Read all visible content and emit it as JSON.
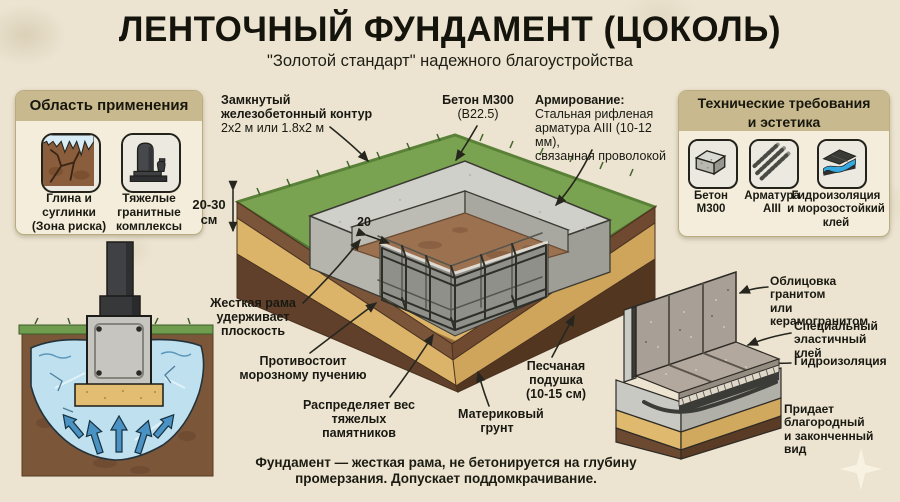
{
  "header": {
    "title": "ЛЕНТОЧНЫЙ ФУНДАМЕНТ (ЦОКОЛЬ)",
    "subtitle": "\"Золотой стандарт\" надежного благоустройства"
  },
  "left_panel": {
    "title": "Область применения",
    "items": [
      {
        "icon": "cracked-clay-icon",
        "label": "Глина и\nсуглинки\n(Зона риска)"
      },
      {
        "icon": "gravestone-icon",
        "label": "Тяжелые\nгранитные\nкомплексы"
      }
    ]
  },
  "right_panel": {
    "title": "Технические требования\nи эстетика",
    "items": [
      {
        "icon": "concrete-block-icon",
        "label": "Бетон\nМ300"
      },
      {
        "icon": "rebar-icon",
        "label": "Арматура\nAIII"
      },
      {
        "icon": "waterproofing-icon",
        "label": "Гидроизоляция\nи морозостойкий\nклей"
      }
    ]
  },
  "diagram": {
    "callouts": {
      "contour_title": "Замкнутый\nжелезобетонный контур",
      "contour_sub": "2х2 м или 1.8х2 м",
      "concrete_title": "Бетон М300",
      "concrete_sub": "(В22.5)",
      "reinforcement_title": "Армирование:",
      "reinforcement_body": "Стальная рифленая\nарматура AIII (10-12 мм),\nсвязанная проволокой",
      "rigid_frame": "Жесткая рама\nудерживает\nплоскость",
      "frost": "Противостоит\nморозному пучению",
      "weight": "Распределяет вес\nтяжелых памятников",
      "sand_pad": "Песчаная\nподушка\n(10-15 см)",
      "bedrock": "Материковый\nгрунт",
      "depth_dim": "20-30\nсм",
      "width_dim": "20"
    }
  },
  "detail": {
    "cladding": "Облицовка гранитом\nили керамогранитом",
    "glue": "Специальный\nэластичный клей",
    "waterproofing": "Гидроизоляция",
    "aesthetic": "Придает\nблагородный\nи законченный вид"
  },
  "footnote": "Фундамент — жесткая рама, не бетонируется на глубину\nпромерзания. Допускает поддомкрачивание.",
  "colors": {
    "background": "#ECE4D1",
    "panel_header": "#C9B98E",
    "grass": "#7AA351",
    "concrete": "#D0D0CA",
    "sand": "#DCB469",
    "soil": "#8A5F3E",
    "ice_blue": "#BFE0EF",
    "arrow_blue": "#4A92C4",
    "granite": "#A89F96"
  }
}
